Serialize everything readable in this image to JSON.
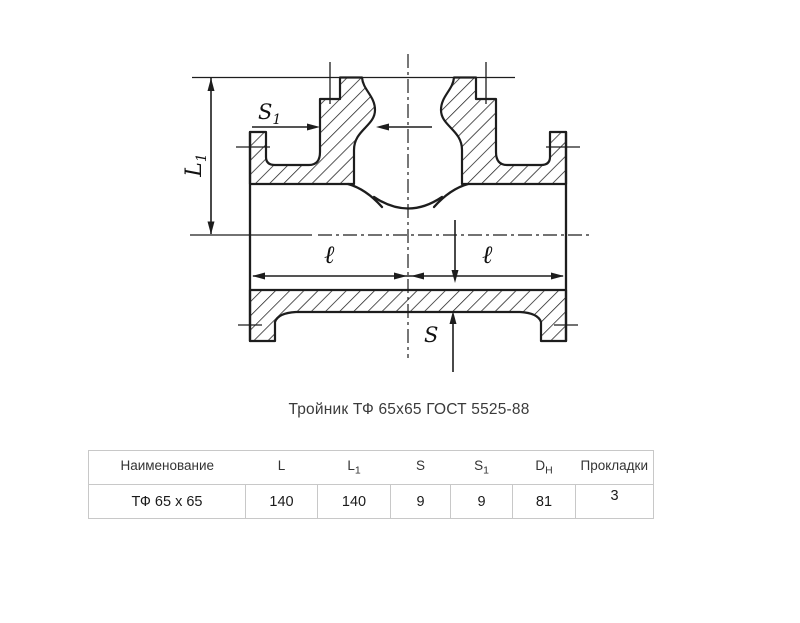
{
  "caption": "Тройник ТФ 65х65 ГОСТ 5525-88",
  "drawing": {
    "kind": "sectioned flanged tee, front view",
    "dims": {
      "l1": {
        "base": "L",
        "sub": "1"
      },
      "s1": {
        "base": "S",
        "sub": "1"
      },
      "l_left": "ℓ",
      "l_right": "ℓ",
      "s": "S"
    }
  },
  "table": {
    "headers": [
      {
        "base": "Наименование",
        "sub": ""
      },
      {
        "base": "L",
        "sub": ""
      },
      {
        "base": "L",
        "sub": "1"
      },
      {
        "base": "S",
        "sub": ""
      },
      {
        "base": "S",
        "sub": "1"
      },
      {
        "base": "D",
        "sub": "Н"
      },
      {
        "base": "Прокладки",
        "sub": ""
      }
    ],
    "row": [
      "ТФ 65 х 65",
      "140",
      "140",
      "9",
      "9",
      "81",
      "3"
    ]
  },
  "colors": {
    "line_color": "#1d1d1d",
    "table_border_color": "#c8c8c8"
  }
}
